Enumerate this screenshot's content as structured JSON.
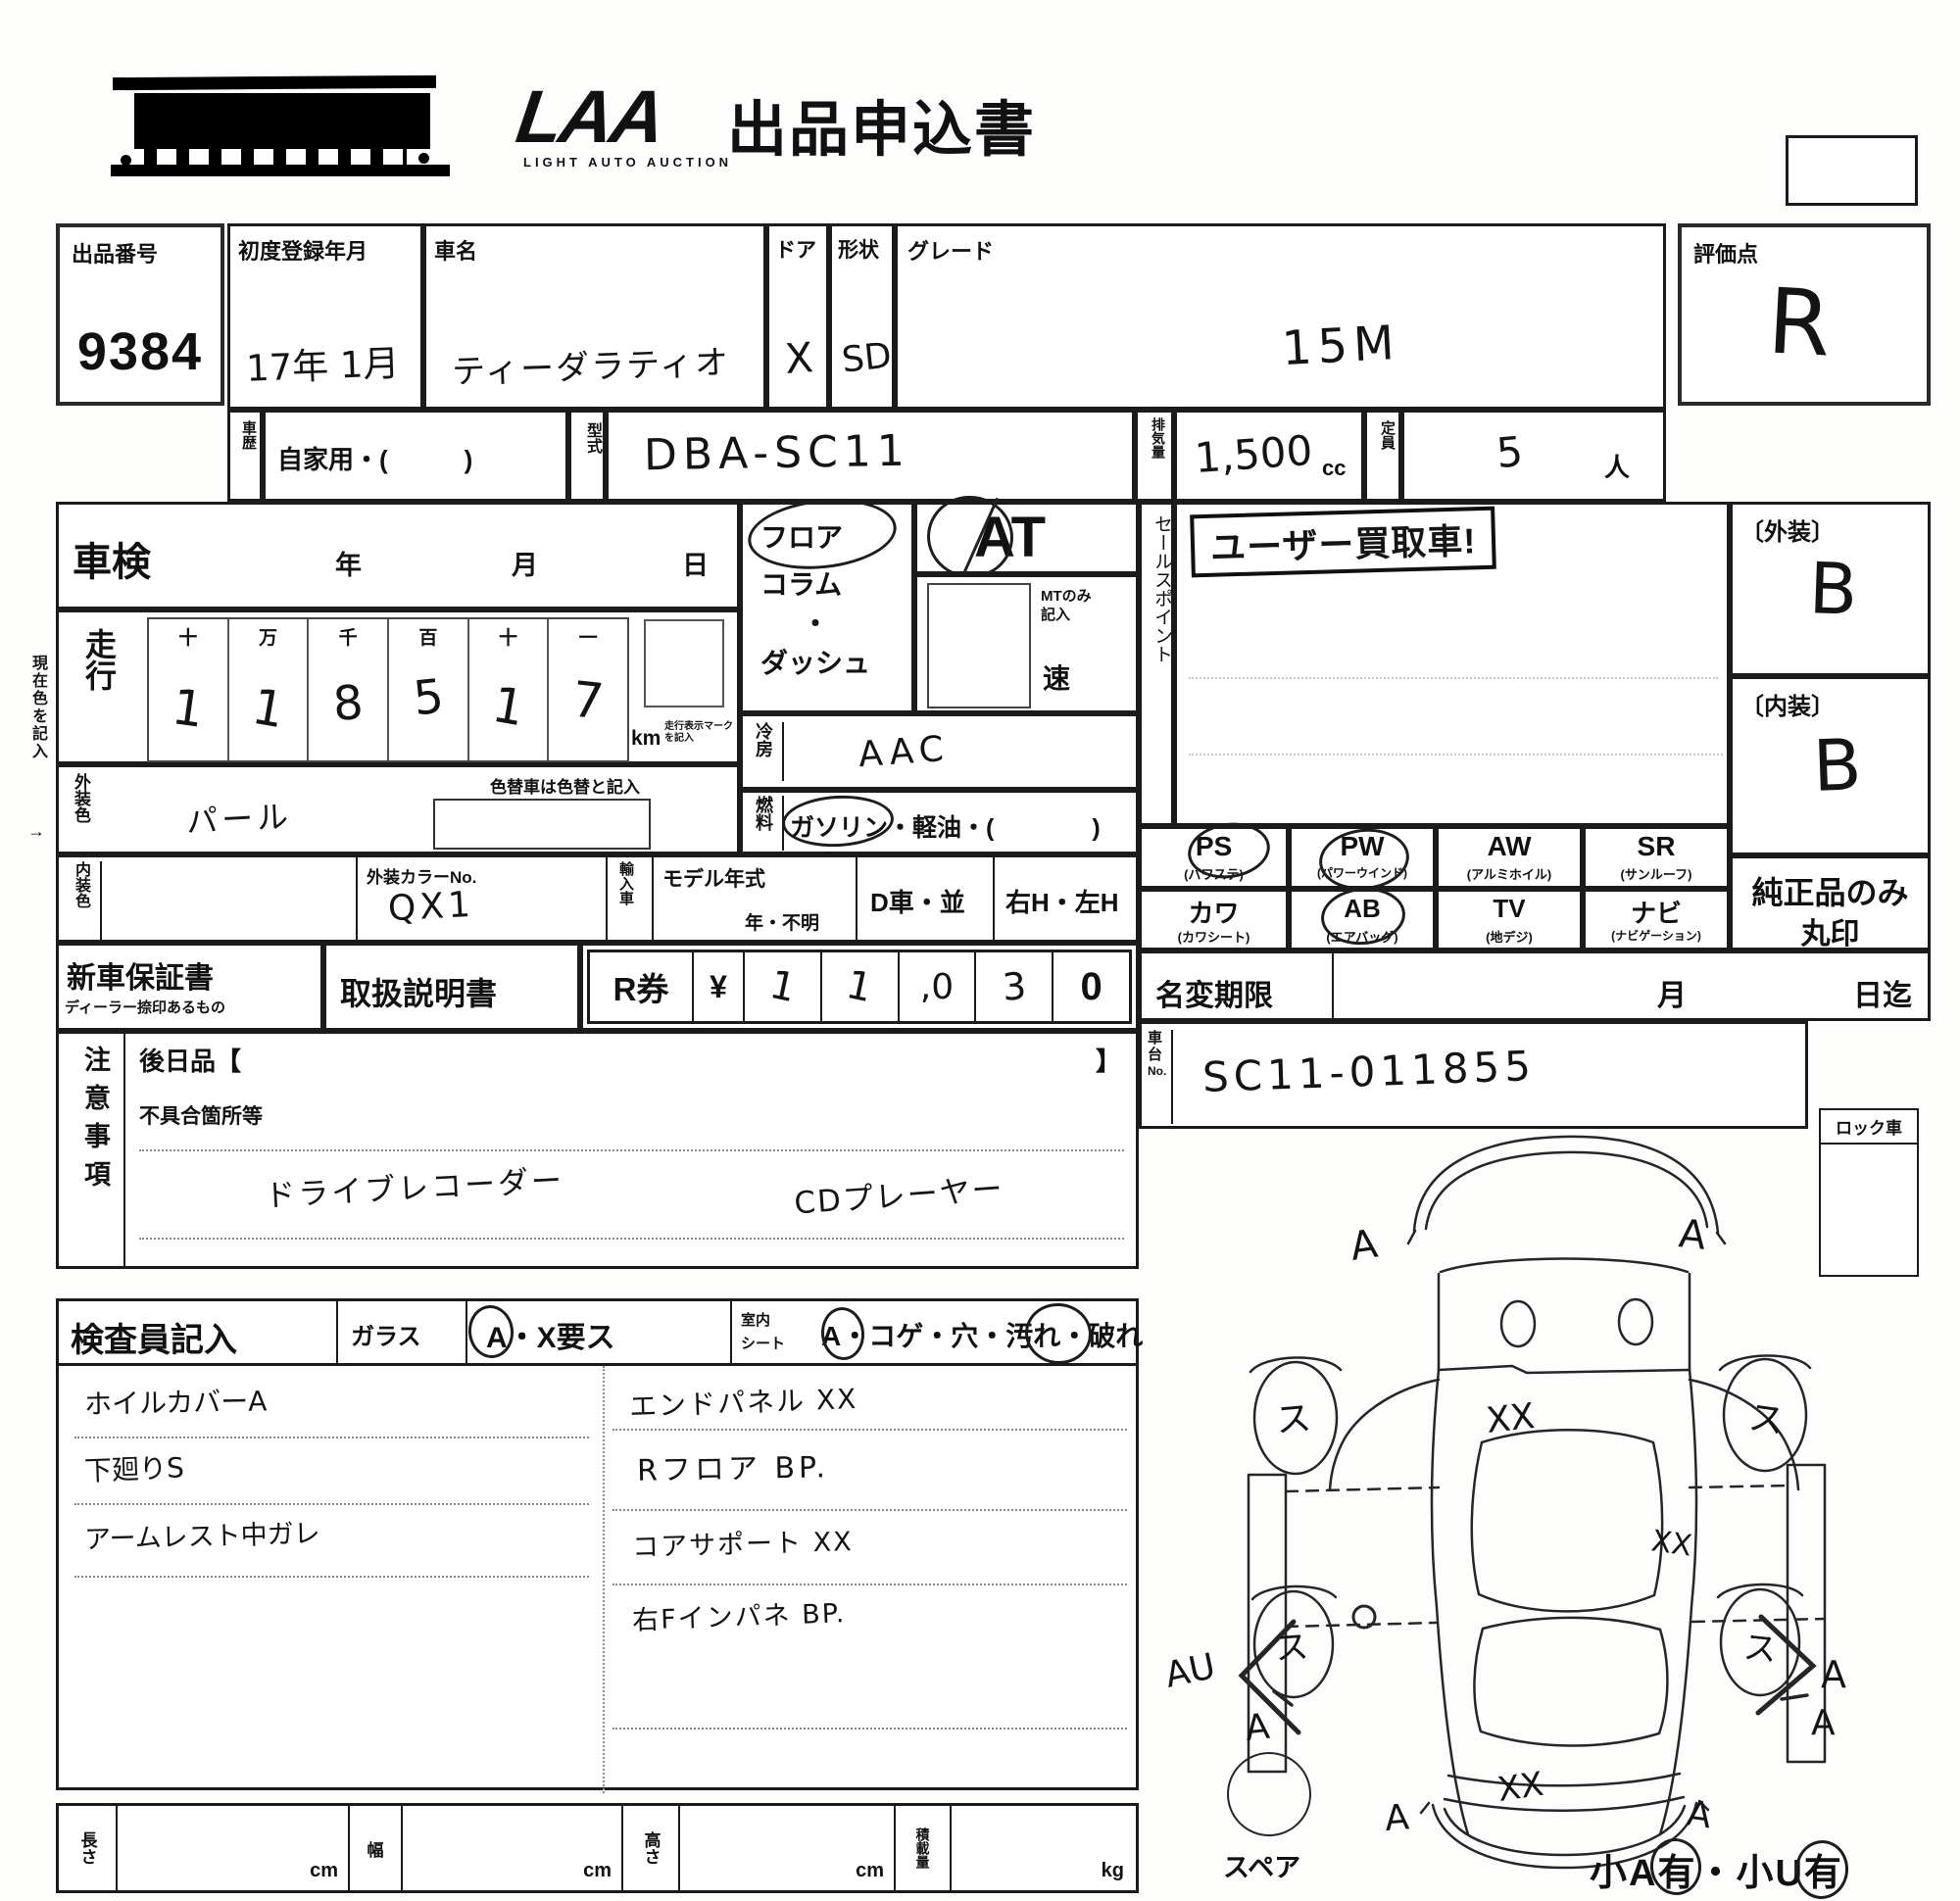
{
  "header": {
    "logo": "LAA",
    "logo_sub": "LIGHT AUTO AUCTION",
    "title": "出品申込書"
  },
  "lot": {
    "label": "出品番号",
    "number": "9384"
  },
  "vehicle": {
    "reg_label": "初度登録年月",
    "reg_value": "17年 1月",
    "name_label": "車名",
    "name": "ティーダラティオ",
    "door_label": "ドア",
    "door": "X",
    "shape_label": "形状",
    "shape": "SD",
    "grade_label": "グレード",
    "grade": "15M",
    "history_label": "車歴",
    "history": "自家用・(　　　)",
    "model_label": "型式",
    "model_code": "DBA-SC11",
    "disp_label": "排気量",
    "displacement": "1,500",
    "disp_unit": "cc",
    "cap_label": "定員",
    "capacity": "5",
    "cap_unit": "人"
  },
  "rating": {
    "label": "評価点",
    "score": "R",
    "ext_label": "〔外装〕",
    "ext": "B",
    "int_label": "〔内装〕",
    "int": "B",
    "genuine1": "純正品のみ",
    "genuine2": "丸印"
  },
  "shaken": {
    "label": "車検",
    "year": "年",
    "month": "月",
    "day": "日"
  },
  "mileage": {
    "label": "走行",
    "headers": [
      "十",
      "万",
      "千",
      "百",
      "十",
      "一"
    ],
    "digits": [
      "1",
      "1",
      "8",
      "5",
      "1",
      "7"
    ],
    "unit": "km",
    "unit_note1": "走行表示マーク",
    "unit_note2": "を記入"
  },
  "color": {
    "ext_label": "外装色",
    "ext_value": "パール",
    "recolor_note": "色替車は色替と記入",
    "int_label": "内装色",
    "color_no_label": "外装カラーNo.",
    "color_no": "QX1",
    "import_label": "輸入車",
    "my_label": "モデル年式",
    "my_opts": "年・不明",
    "d_car": "D車・並",
    "handle": "右H・左H"
  },
  "shift": {
    "floor": "フロア",
    "column": "コラム",
    "dot": "・",
    "dash": "ダッシュ",
    "at": "AT",
    "mt1": "MTのみ",
    "mt2": "記入",
    "speed": "速"
  },
  "aircon": {
    "label": "冷房",
    "value": "AAC"
  },
  "fuel": {
    "label": "燃料",
    "value": "ガソリン・軽油・(　　　　)"
  },
  "sales": {
    "label": "セールスポイント",
    "stamp": "ユーザー買取車!"
  },
  "equipment": {
    "row1": [
      {
        "code": "PS",
        "name": "(パワステ)"
      },
      {
        "code": "PW",
        "name": "(パワーウインド)"
      },
      {
        "code": "AW",
        "name": "(アルミホイル)"
      },
      {
        "code": "SR",
        "name": "(サンルーフ)"
      }
    ],
    "row2": [
      {
        "code": "カワ",
        "name": "(カワシート)"
      },
      {
        "code": "AB",
        "name": "(エアバッグ)"
      },
      {
        "code": "TV",
        "name": "(地デジ)"
      },
      {
        "code": "ナビ",
        "name": "(ナビゲーション)"
      }
    ]
  },
  "warranty": {
    "new_car": "新車保証書",
    "new_car_sub": "ディーラー捺印あるもの",
    "manual": "取扱説明書",
    "rticket": "R券",
    "yen": "¥",
    "amount_cells": [
      "1",
      "1",
      ",0",
      "3",
      "0"
    ]
  },
  "namechange": {
    "label": "名変期限",
    "month": "月",
    "until": "日迄"
  },
  "chassis": {
    "label1": "車",
    "label2": "台",
    "label3": "No.",
    "value": "SC11-011855"
  },
  "caution": {
    "label": "注意事項",
    "later": "後日品【",
    "later_close": "】",
    "defect": "不具合箇所等",
    "note1": "ドライブレコーダー",
    "note2": "CDプレーヤー"
  },
  "inspector": {
    "label": "検査員記入",
    "glass": "ガラス",
    "glass_opts": "A・X要ス",
    "cabin1": "室内",
    "cabin2": "シート",
    "seat_opts": "A・コゲ・穴・汚れ・破れ",
    "left_notes": [
      "ホイルカバーA",
      "下廻りS",
      "アームレスト中ガレ"
    ],
    "right_notes": [
      "エンドパネル XX",
      "Rフロア BP.",
      "コアサポート XX",
      "右Fインパネ BP."
    ]
  },
  "dims": {
    "length": "長さ",
    "width": "幅",
    "height": "高さ",
    "load": "積載量",
    "cm": "cm",
    "kg": "kg"
  },
  "diagram": {
    "lock": "ロック車",
    "spare": "スペア",
    "size_note": "小A有・小U有",
    "marks": {
      "a": "A",
      "wheel": "ス",
      "xx": "XX",
      "au": "AU"
    }
  },
  "side_note": {
    "text": "現在色を記入",
    "arrow": "→"
  }
}
